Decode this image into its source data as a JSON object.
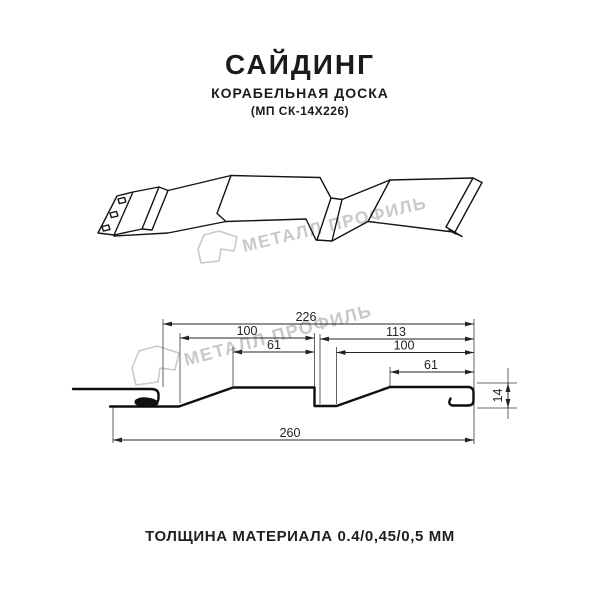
{
  "header": {
    "title": "САЙДИНГ",
    "subtitle": "КОРАБЕЛЬНАЯ ДОСКА",
    "model": "(МП СК-14Х226)"
  },
  "watermark": {
    "text": "МЕТАЛЛ ПРОФИЛЬ",
    "color": "#c9c9c9"
  },
  "dimensions": {
    "overall_width": "226",
    "left_panel": "100",
    "left_flat": "61",
    "right_panel": "113",
    "right_inner": "100",
    "right_flat": "61",
    "total_width": "260",
    "profile_height": "14"
  },
  "footer": {
    "thickness_label": "ТОЛЩИНА МАТЕРИАЛА 0.4/0,45/0,5 ММ"
  },
  "colors": {
    "background": "#ffffff",
    "line": "#141414",
    "dimension": "#232323",
    "watermark": "#c9c9c9",
    "text": "#1b1b1b"
  }
}
